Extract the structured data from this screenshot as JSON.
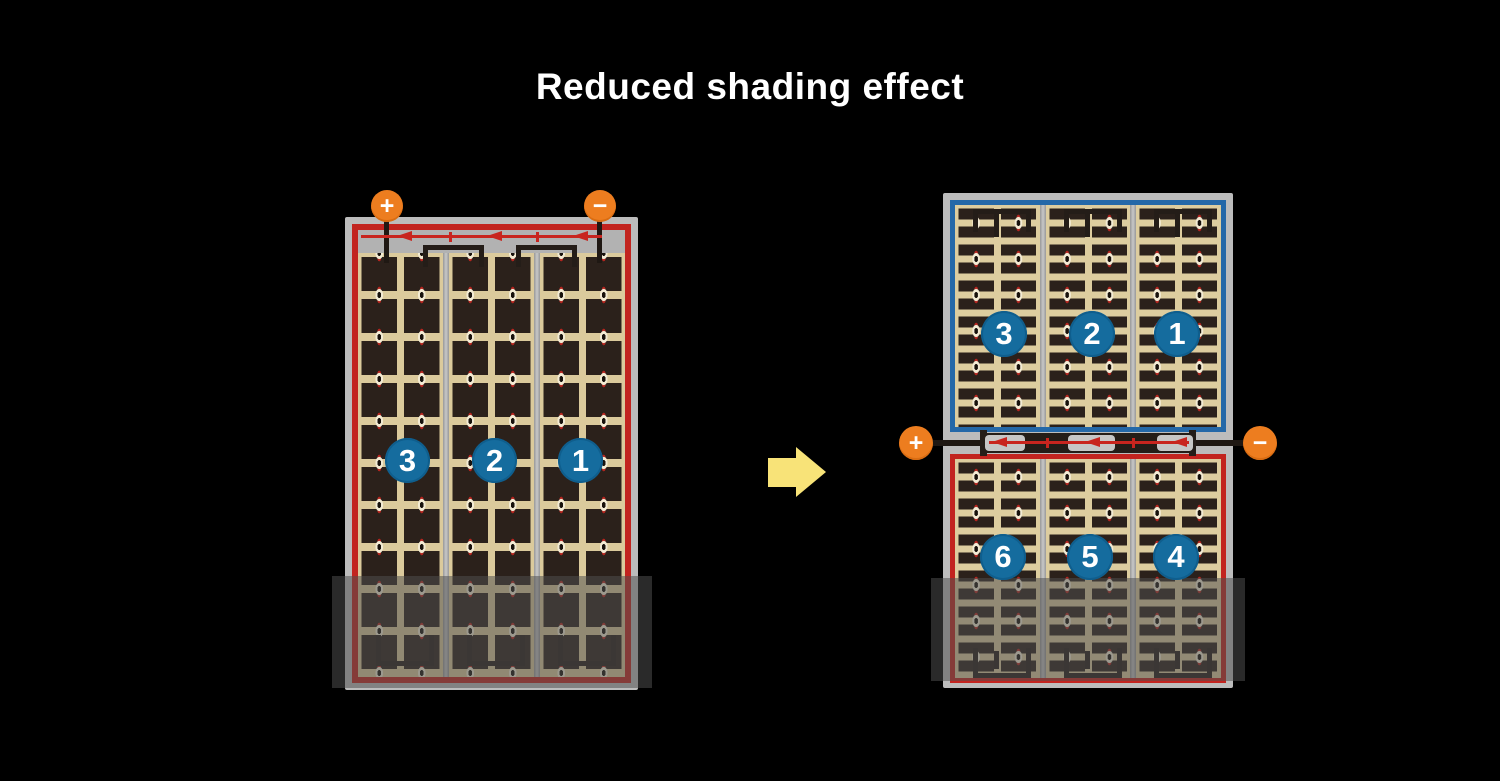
{
  "title": "Reduced shading effect",
  "colors": {
    "background": "#000000",
    "title_text": "#ffffff",
    "panel_frame_gray": "#bcbcbc",
    "cell_dark": "#2b211b",
    "cell_bg_tan": "#dbca9c",
    "string_red": "#c2241f",
    "half_blue": "#2468a8",
    "number_circle_blue": "#156c9e",
    "terminal_orange": "#ed7d1f",
    "busbar_black": "#241d18",
    "arrow_yellow": "#f8e378"
  },
  "left_panel": {
    "positive_terminal": "+",
    "negative_terminal": "−",
    "cell_strings": [
      "3",
      "2",
      "1"
    ]
  },
  "right_panel": {
    "positive_terminal": "+",
    "negative_terminal": "−",
    "top_cell_strings": [
      "3",
      "2",
      "1"
    ],
    "bottom_cell_strings": [
      "6",
      "5",
      "4"
    ]
  }
}
